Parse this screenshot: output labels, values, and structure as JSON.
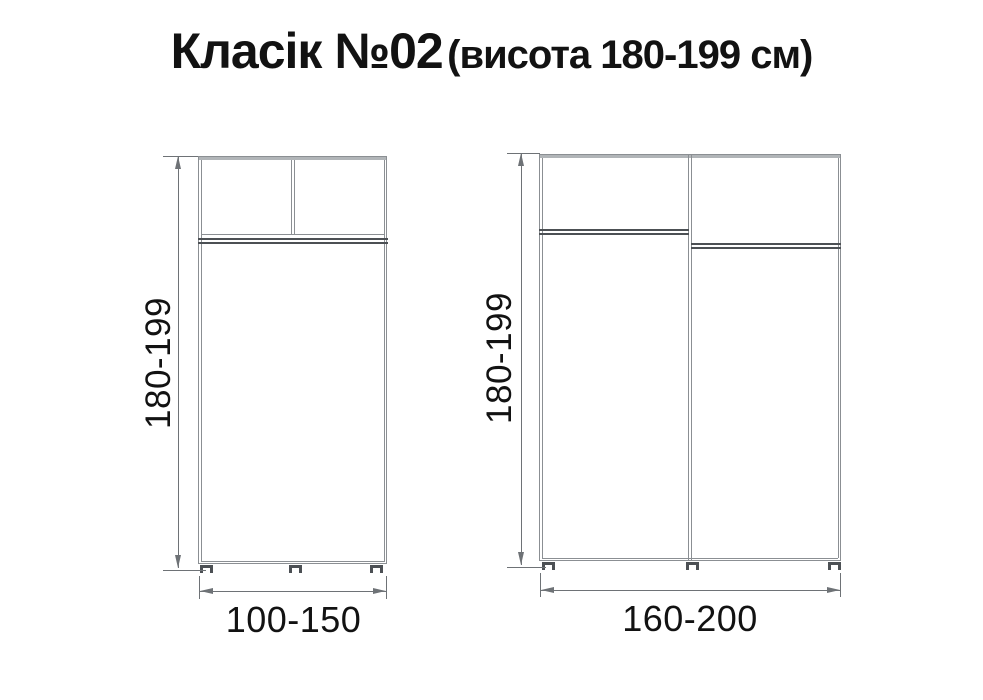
{
  "title": {
    "main": "Класік №02",
    "sub": "(висота 180-199 см)"
  },
  "wardrobes": [
    {
      "id": "small",
      "height_label": "180-199",
      "width_label": "100-150"
    },
    {
      "id": "large",
      "height_label": "180-199",
      "width_label": "160-200"
    }
  ],
  "colors": {
    "line": "#8b8f93",
    "line_dark": "#4c5054",
    "line_light": "#b1b5b8",
    "dim": "#6e7276",
    "text": "#121212",
    "bg": "#ffffff"
  }
}
